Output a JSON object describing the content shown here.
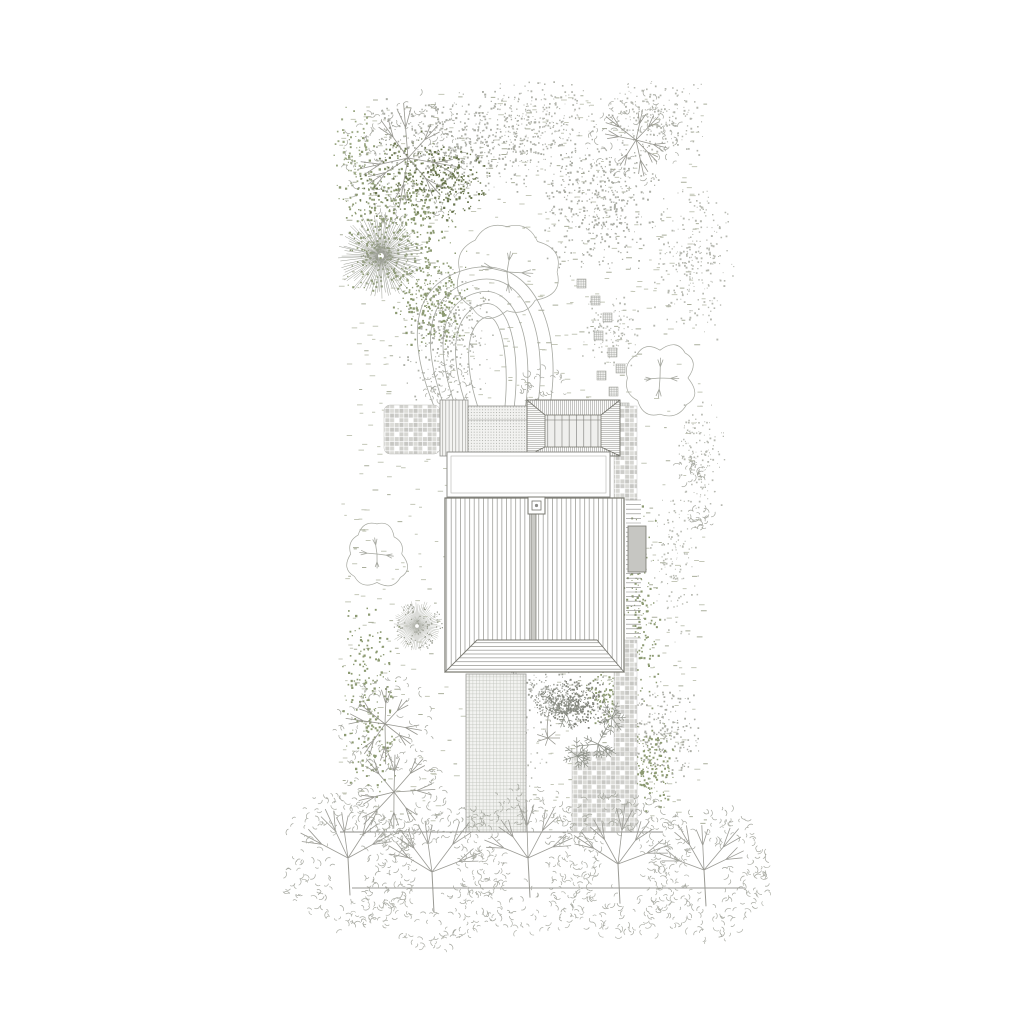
{
  "drawing": {
    "kind": "architectural-site-plan-roof-plan-with-garden",
    "canvas": {
      "width": 1024,
      "height": 1024,
      "background": "#ffffff"
    }
  },
  "palette": {
    "building_line": "#77776f",
    "line": "#8f8f8b",
    "veg_line": "#a6a8a0",
    "veg_line_dark": "#96968f",
    "grass_dash": "#c4c7b8",
    "grass_dash_dark": "#a9ae9b",
    "green": "#8c9a72",
    "green_dark": "#68754d",
    "speckle_gray": "#abada5",
    "fill_gray": "#c6c6c2",
    "fill_light": "#f0f0ee",
    "white": "#ffffff"
  },
  "grass": {
    "x": 338,
    "y": 94,
    "w": 366,
    "h": 738,
    "count": 950,
    "seed": 5,
    "exclude": [
      [
        383,
        398,
        256,
        60
      ],
      [
        445,
        456,
        179,
        216
      ],
      [
        463,
        672,
        66,
        162
      ],
      [
        571,
        750,
        68,
        84
      ],
      [
        613,
        456,
        28,
        378
      ]
    ]
  },
  "speckle_clusters": [
    {
      "cx": 470,
      "cy": 143,
      "rx": 118,
      "ry": 55,
      "n": 650,
      "size": 1.5,
      "color": "#abada5",
      "seed": 11
    },
    {
      "cx": 600,
      "cy": 205,
      "rx": 62,
      "ry": 72,
      "n": 430,
      "size": 1.5,
      "color": "#abada5",
      "seed": 12
    },
    {
      "cx": 655,
      "cy": 118,
      "rx": 52,
      "ry": 42,
      "n": 230,
      "size": 1.4,
      "color": "#b3b5ad",
      "seed": 13
    },
    {
      "cx": 692,
      "cy": 262,
      "rx": 42,
      "ry": 82,
      "n": 260,
      "size": 1.4,
      "color": "#b6b8b0",
      "seed": 14
    },
    {
      "cx": 447,
      "cy": 332,
      "rx": 52,
      "ry": 70,
      "n": 300,
      "size": 1.4,
      "color": "#aeb0a8",
      "seed": 15
    },
    {
      "cx": 700,
      "cy": 452,
      "rx": 26,
      "ry": 65,
      "n": 150,
      "size": 1.3,
      "color": "#b6b8b0",
      "seed": 16
    },
    {
      "cx": 672,
      "cy": 560,
      "rx": 28,
      "ry": 85,
      "n": 140,
      "size": 1.3,
      "color": "#babcb4",
      "seed": 17
    },
    {
      "cx": 662,
      "cy": 732,
      "rx": 40,
      "ry": 58,
      "n": 240,
      "size": 1.4,
      "color": "#abada5",
      "seed": 18
    },
    {
      "cx": 577,
      "cy": 703,
      "rx": 34,
      "ry": 28,
      "n": 320,
      "size": 1.4,
      "color": "#80837a",
      "seed": 19
    },
    {
      "cx": 506,
      "cy": 758,
      "rx": 42,
      "ry": 48,
      "n": 170,
      "size": 1.3,
      "color": "#b3b5ad",
      "seed": 20
    },
    {
      "cx": 545,
      "cy": 118,
      "rx": 60,
      "ry": 40,
      "n": 200,
      "size": 1.3,
      "color": "#b3b5ad",
      "seed": 32
    },
    {
      "cx": 610,
      "cy": 330,
      "rx": 30,
      "ry": 40,
      "n": 120,
      "size": 1.3,
      "color": "#b6b8b0",
      "seed": 33
    },
    {
      "cx": 540,
      "cy": 690,
      "rx": 50,
      "ry": 40,
      "n": 150,
      "size": 1.3,
      "color": "#9ea099",
      "seed": 34
    },
    {
      "cx": 398,
      "cy": 214,
      "rx": 62,
      "ry": 82,
      "n": 420,
      "size": 1.7,
      "color": "#8c9a72",
      "seed": 21
    },
    {
      "cx": 431,
      "cy": 300,
      "rx": 40,
      "ry": 58,
      "n": 250,
      "size": 1.7,
      "color": "#8c9a72",
      "seed": 22
    },
    {
      "cx": 352,
      "cy": 158,
      "rx": 22,
      "ry": 55,
      "n": 80,
      "size": 1.6,
      "color": "#9aa782",
      "seed": 23
    },
    {
      "cx": 370,
      "cy": 706,
      "rx": 30,
      "ry": 105,
      "n": 230,
      "size": 1.7,
      "color": "#8c9a72",
      "seed": 24
    },
    {
      "cx": 641,
      "cy": 612,
      "rx": 20,
      "ry": 115,
      "n": 150,
      "size": 1.6,
      "color": "#8c9a72",
      "seed": 25
    },
    {
      "cx": 648,
      "cy": 764,
      "rx": 28,
      "ry": 52,
      "n": 160,
      "size": 1.6,
      "color": "#8c9a72",
      "seed": 26
    },
    {
      "cx": 452,
      "cy": 182,
      "rx": 40,
      "ry": 40,
      "n": 180,
      "size": 1.6,
      "color": "#68754d",
      "seed": 27
    },
    {
      "cx": 545,
      "cy": 650,
      "rx": 24,
      "ry": 16,
      "n": 60,
      "size": 1.5,
      "color": "#8c9a72",
      "seed": 28
    },
    {
      "cx": 608,
      "cy": 694,
      "rx": 24,
      "ry": 32,
      "n": 90,
      "size": 1.5,
      "color": "#8c9a72",
      "seed": 29
    },
    {
      "cx": 381,
      "cy": 256,
      "rx": 38,
      "ry": 38,
      "n": 130,
      "size": 1.6,
      "color": "#8c9a72",
      "seed": 30
    },
    {
      "cx": 406,
      "cy": 178,
      "rx": 52,
      "ry": 50,
      "n": 140,
      "size": 1.6,
      "color": "#68754d",
      "seed": 31
    }
  ],
  "trees": [
    {
      "type": "branchy",
      "cx": 408,
      "cy": 158,
      "r": 62,
      "seed": 41
    },
    {
      "type": "conifer",
      "cx": 381,
      "cy": 256,
      "r": 42,
      "seed": 42
    },
    {
      "type": "branchy",
      "cx": 636,
      "cy": 140,
      "r": 44,
      "seed": 43
    },
    {
      "type": "lobed",
      "cx": 507,
      "cy": 272,
      "r": 45,
      "seed": 44
    },
    {
      "type": "lobed",
      "cx": 660,
      "cy": 378,
      "r": 33,
      "seed": 45
    },
    {
      "type": "lobed",
      "cx": 377,
      "cy": 554,
      "r": 29,
      "seed": 46
    },
    {
      "type": "dotcone",
      "cx": 417,
      "cy": 626,
      "r": 25,
      "seed": 47
    },
    {
      "type": "branchy",
      "cx": 385,
      "cy": 724,
      "r": 47,
      "seed": 48
    },
    {
      "type": "branchy",
      "cx": 394,
      "cy": 792,
      "r": 51,
      "seed": 49
    },
    {
      "type": "shrub",
      "cx": 447,
      "cy": 386,
      "r": 26,
      "seed": 50
    },
    {
      "type": "shrub",
      "cx": 543,
      "cy": 387,
      "r": 23,
      "seed": 51
    },
    {
      "type": "shrub",
      "cx": 690,
      "cy": 470,
      "r": 14,
      "seed": 52
    },
    {
      "type": "shrub",
      "cx": 700,
      "cy": 520,
      "r": 12,
      "seed": 53
    },
    {
      "type": "dandelion",
      "cx": 549,
      "cy": 702,
      "r": 16,
      "seed": 54
    }
  ],
  "ferns": [
    {
      "cx": 566,
      "cy": 712,
      "r": 20,
      "seed": 71
    },
    {
      "cx": 598,
      "cy": 744,
      "r": 22,
      "seed": 72
    },
    {
      "cx": 577,
      "cy": 756,
      "r": 18,
      "seed": 73
    },
    {
      "cx": 612,
      "cy": 718,
      "r": 16,
      "seed": 74
    }
  ],
  "stepping_stones": {
    "size": 9,
    "positions": [
      [
        577,
        279
      ],
      [
        591,
        296
      ],
      [
        603,
        313
      ],
      [
        594,
        331
      ],
      [
        608,
        348
      ],
      [
        616,
        364
      ],
      [
        597,
        371
      ],
      [
        609,
        387
      ],
      [
        620,
        403
      ]
    ]
  },
  "winding_path": {
    "stroke": "#a5a7a0",
    "lines": [
      "M438,416 C400,328 416,280 472,268 C535,256 566,332 548,416",
      "M448,416 C416,336 429,290 477,280 C526,270 551,336 536,416",
      "M459,416 C431,344 441,300 480,292 C516,285 537,342 524,416",
      "M470,416 C446,354 453,312 483,304 C508,298 523,348 513,416",
      "M481,416 C462,364 466,324 486,317 C500,312 511,356 504,416"
    ]
  },
  "buildings": {
    "left_mosaic": {
      "x": 384,
      "y": 405,
      "w": 56,
      "h": 49
    },
    "plank_deck": {
      "x": 440,
      "y": 400,
      "w": 28,
      "h": 56
    },
    "dotted_deck": {
      "x": 468,
      "y": 406,
      "w": 59,
      "h": 47,
      "band_y": 420
    },
    "annex": {
      "x": 527,
      "y": 400,
      "w": 93,
      "h": 56,
      "inner": {
        "x": 545,
        "y": 415,
        "w": 56,
        "h": 32
      }
    },
    "courtyard": {
      "x": 447,
      "y": 452,
      "w": 163,
      "h": 45,
      "inset": 4
    },
    "main_roof": {
      "x": 445,
      "y": 498,
      "w": 179,
      "h": 174,
      "stripe": 4.6,
      "ridge_x": 531,
      "ridge_w": 5,
      "chimney": {
        "x": 528,
        "y": 497,
        "s": 17
      },
      "porch": {
        "y_top": 640,
        "top_x1": 477,
        "top_x2": 597
      }
    },
    "stair": {
      "x": 626,
      "y": 500,
      "w": 15,
      "h": 140,
      "step": 4.6,
      "box": {
        "x": 628,
        "y": 526,
        "w": 18,
        "h": 46
      }
    },
    "garden_path": {
      "x": 466,
      "y": 674,
      "w": 60,
      "h": 158
    },
    "mosaic_strip_top": {
      "x": 614,
      "y": 406,
      "w": 23,
      "h": 94
    },
    "mosaic_strip_bottom": {
      "x": 614,
      "y": 640,
      "w": 23,
      "h": 192
    },
    "mosaic_patch": {
      "x": 572,
      "y": 752,
      "w": 65,
      "h": 80
    }
  },
  "site_lines": {
    "boundary": {
      "x1": 340,
      "y1": 832,
      "x2": 663,
      "y2": 832
    },
    "street": {
      "x1": 352,
      "y1": 888,
      "x2": 745,
      "y2": 888
    }
  },
  "street_trees": [
    {
      "cx": 348,
      "cy": 858,
      "r": 68,
      "seed": 61
    },
    {
      "cx": 432,
      "cy": 872,
      "r": 74,
      "seed": 62
    },
    {
      "cx": 528,
      "cy": 858,
      "r": 72,
      "seed": 63
    },
    {
      "cx": 618,
      "cy": 864,
      "r": 72,
      "seed": 64
    },
    {
      "cx": 704,
      "cy": 870,
      "r": 66,
      "seed": 65
    }
  ]
}
